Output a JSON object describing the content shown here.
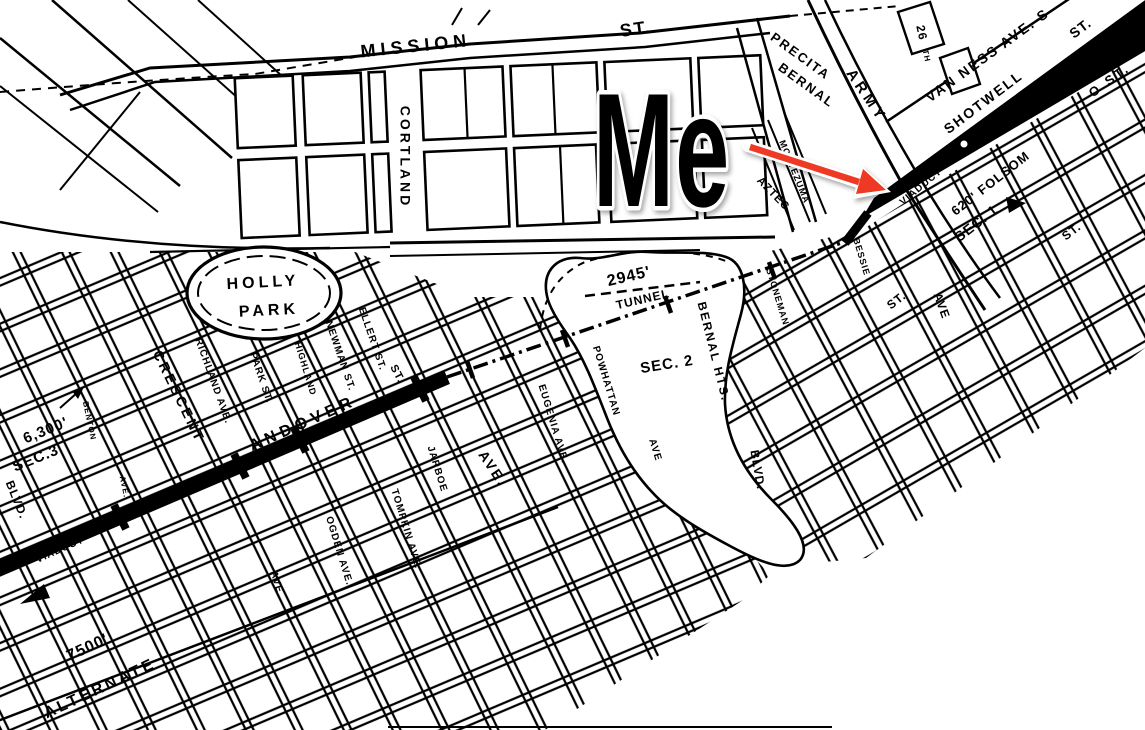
{
  "figure": {
    "width": 1145,
    "height": 730,
    "background": "#ffffff",
    "ink": "#000000"
  },
  "annotation": {
    "label": "Me",
    "color": "#ee3a24",
    "outline": "#ffffff"
  },
  "map": {
    "labels": [
      {
        "id": "mission",
        "text": "MISSION",
        "x": 416,
        "y": 47,
        "rot": -6,
        "size": 18,
        "ls": 5
      },
      {
        "id": "mission-st",
        "text": "ST.",
        "x": 636,
        "y": 30,
        "rot": -8,
        "size": 18,
        "ls": 2
      },
      {
        "id": "cortland",
        "text": "CORTLAND",
        "x": 404,
        "y": 157,
        "rot": 90,
        "size": 14,
        "ls": 3
      },
      {
        "id": "holly",
        "text": "HOLLY",
        "x": 263,
        "y": 283,
        "rot": -3,
        "size": 16,
        "ls": 4
      },
      {
        "id": "holly-park",
        "text": "PARK",
        "x": 269,
        "y": 311,
        "rot": -3,
        "size": 16,
        "ls": 4
      },
      {
        "id": "precita",
        "text": "PRECITA",
        "x": 800,
        "y": 57,
        "rot": 36,
        "size": 13,
        "ls": 2
      },
      {
        "id": "bernal",
        "text": "BERNAL",
        "x": 806,
        "y": 86,
        "rot": 36,
        "size": 13,
        "ls": 2
      },
      {
        "id": "montezuma",
        "text": "MONTEZUMA",
        "x": 794,
        "y": 172,
        "rot": 68,
        "size": 9,
        "ls": 1
      },
      {
        "id": "aztec",
        "text": "AZTEC",
        "x": 773,
        "y": 194,
        "rot": 46,
        "size": 11,
        "ls": 1
      },
      {
        "id": "army",
        "text": "ARMY",
        "x": 866,
        "y": 96,
        "rot": 56,
        "size": 15,
        "ls": 4
      },
      {
        "id": "st-26",
        "text": "26",
        "x": 921,
        "y": 33,
        "rot": 78,
        "size": 12,
        "ls": 1
      },
      {
        "id": "st-26-suffix",
        "text": "TH",
        "x": 926,
        "y": 56,
        "rot": 78,
        "size": 8,
        "ls": 1
      },
      {
        "id": "van-ness",
        "text": "VAN NESS AVE. S",
        "x": 988,
        "y": 56,
        "rot": -36,
        "size": 14,
        "ls": 2
      },
      {
        "id": "shotwell",
        "text": "SHOTWELL",
        "x": 984,
        "y": 103,
        "rot": -37,
        "size": 14,
        "ls": 2
      },
      {
        "id": "shotwell-st",
        "text": "ST.",
        "x": 1081,
        "y": 29,
        "rot": -37,
        "size": 14,
        "ls": 1
      },
      {
        "id": "o-st",
        "text": "O ST.",
        "x": 1110,
        "y": 81,
        "rot": -36,
        "size": 13,
        "ls": 3
      },
      {
        "id": "viaduct-ne",
        "text": "VIADUCT",
        "x": 921,
        "y": 187,
        "rot": -40,
        "size": 10,
        "ls": 1
      },
      {
        "id": "bessie",
        "text": "BESSIE",
        "x": 861,
        "y": 257,
        "rot": 73,
        "size": 9,
        "ls": 1
      },
      {
        "id": "stoneman",
        "text": "STONEMAN",
        "x": 777,
        "y": 297,
        "rot": 73,
        "size": 9,
        "ls": 1
      },
      {
        "id": "folsom-620",
        "text": "620' FOLSOM",
        "x": 991,
        "y": 184,
        "rot": -38,
        "size": 13,
        "ls": 1
      },
      {
        "id": "sec-1",
        "text": "SEC. 1",
        "x": 977,
        "y": 224,
        "rot": -38,
        "size": 14,
        "ls": 1
      },
      {
        "id": "st-right-upper",
        "text": "ST.",
        "x": 1072,
        "y": 232,
        "rot": -38,
        "size": 12,
        "ls": 1
      },
      {
        "id": "st-right-lower",
        "text": "ST.",
        "x": 897,
        "y": 301,
        "rot": -38,
        "size": 12,
        "ls": 1
      },
      {
        "id": "ave-right",
        "text": "AVE",
        "x": 941,
        "y": 306,
        "rot": 70,
        "size": 12,
        "ls": 1
      },
      {
        "id": "len-2945",
        "text": "2945'",
        "x": 629,
        "y": 277,
        "rot": -13,
        "size": 16,
        "ls": 1
      },
      {
        "id": "tunnel",
        "text": "TUNNEL",
        "x": 643,
        "y": 300,
        "rot": -13,
        "size": 12,
        "ls": 1
      },
      {
        "id": "sec-2",
        "text": "SEC. 2",
        "x": 667,
        "y": 365,
        "rot": -9,
        "size": 15,
        "ls": 1
      },
      {
        "id": "bernal-hts",
        "text": "BERNAL HTS.",
        "x": 713,
        "y": 352,
        "rot": 76,
        "size": 12,
        "ls": 2
      },
      {
        "id": "blvd-right",
        "text": "BLVD.",
        "x": 757,
        "y": 470,
        "rot": 80,
        "size": 12,
        "ls": 1
      },
      {
        "id": "powhattan",
        "text": "POWHATTAN",
        "x": 606,
        "y": 381,
        "rot": 73,
        "size": 10,
        "ls": 1
      },
      {
        "id": "eugenia",
        "text": "EUGENIA AVE.",
        "x": 553,
        "y": 424,
        "rot": 73,
        "size": 10,
        "ls": 1
      },
      {
        "id": "ave-mid",
        "text": "AVE.",
        "x": 492,
        "y": 469,
        "rot": 56,
        "size": 14,
        "ls": 2
      },
      {
        "id": "ave-mid2",
        "text": "AVE",
        "x": 655,
        "y": 450,
        "rot": 73,
        "size": 10,
        "ls": 1
      },
      {
        "id": "crescent",
        "text": "CRESCENT",
        "x": 178,
        "y": 397,
        "rot": 64,
        "size": 14,
        "ls": 3
      },
      {
        "id": "richland",
        "text": "RICHLAND AVE.",
        "x": 213,
        "y": 381,
        "rot": 70,
        "size": 10,
        "ls": 1
      },
      {
        "id": "park-st",
        "text": "PARK ST.",
        "x": 261,
        "y": 378,
        "rot": 71,
        "size": 10,
        "ls": 1
      },
      {
        "id": "highland",
        "text": "HIGHLAND",
        "x": 305,
        "y": 369,
        "rot": 73,
        "size": 9,
        "ls": 1
      },
      {
        "id": "newman",
        "text": "NEWMAN ST.",
        "x": 340,
        "y": 356,
        "rot": 71,
        "size": 10,
        "ls": 1
      },
      {
        "id": "ellert",
        "text": "ELLERT ST.",
        "x": 372,
        "y": 339,
        "rot": 71,
        "size": 10,
        "ls": 1
      },
      {
        "id": "st-andover",
        "text": "ST.",
        "x": 397,
        "y": 374,
        "rot": 62,
        "size": 11,
        "ls": 1
      },
      {
        "id": "andover",
        "text": "ANDOVER",
        "x": 303,
        "y": 424,
        "rot": -24,
        "size": 16,
        "ls": 5
      },
      {
        "id": "len-6300",
        "text": "6,300'",
        "x": 46,
        "y": 431,
        "rot": -22,
        "size": 15,
        "ls": 1
      },
      {
        "id": "sec-3",
        "text": "SEC.3",
        "x": 36,
        "y": 459,
        "rot": -22,
        "size": 15,
        "ls": 1
      },
      {
        "id": "benton",
        "text": "BENTON",
        "x": 89,
        "y": 421,
        "rot": 78,
        "size": 8,
        "ls": 1
      },
      {
        "id": "benton-ave",
        "text": "AVE.",
        "x": 124,
        "y": 487,
        "rot": 78,
        "size": 8,
        "ls": 1
      },
      {
        "id": "blvd-left",
        "text": "BLVD.",
        "x": 16,
        "y": 500,
        "rot": 68,
        "size": 12,
        "ls": 1
      },
      {
        "id": "viaduct-sw",
        "text": "VIADUCT",
        "x": 60,
        "y": 550,
        "rot": -24,
        "size": 10,
        "ls": 1,
        "color": "#ffffff"
      },
      {
        "id": "len-7500",
        "text": "7500'",
        "x": 88,
        "y": 648,
        "rot": -25,
        "size": 16,
        "ls": 1
      },
      {
        "id": "alternate",
        "text": "ALTERNATE",
        "x": 100,
        "y": 689,
        "rot": -25,
        "size": 16,
        "ls": 3
      },
      {
        "id": "ogden",
        "text": "OGDEN AVE.",
        "x": 339,
        "y": 551,
        "rot": 73,
        "size": 10,
        "ls": 1
      },
      {
        "id": "ave-sw",
        "text": "AVE.",
        "x": 277,
        "y": 584,
        "rot": 73,
        "size": 10,
        "ls": 1
      },
      {
        "id": "tompkin",
        "text": "TOMPKIN AVE.",
        "x": 406,
        "y": 529,
        "rot": 73,
        "size": 10,
        "ls": 1
      },
      {
        "id": "jarboe",
        "text": "JARBOE",
        "x": 437,
        "y": 469,
        "rot": 73,
        "size": 10,
        "ls": 1
      }
    ]
  }
}
